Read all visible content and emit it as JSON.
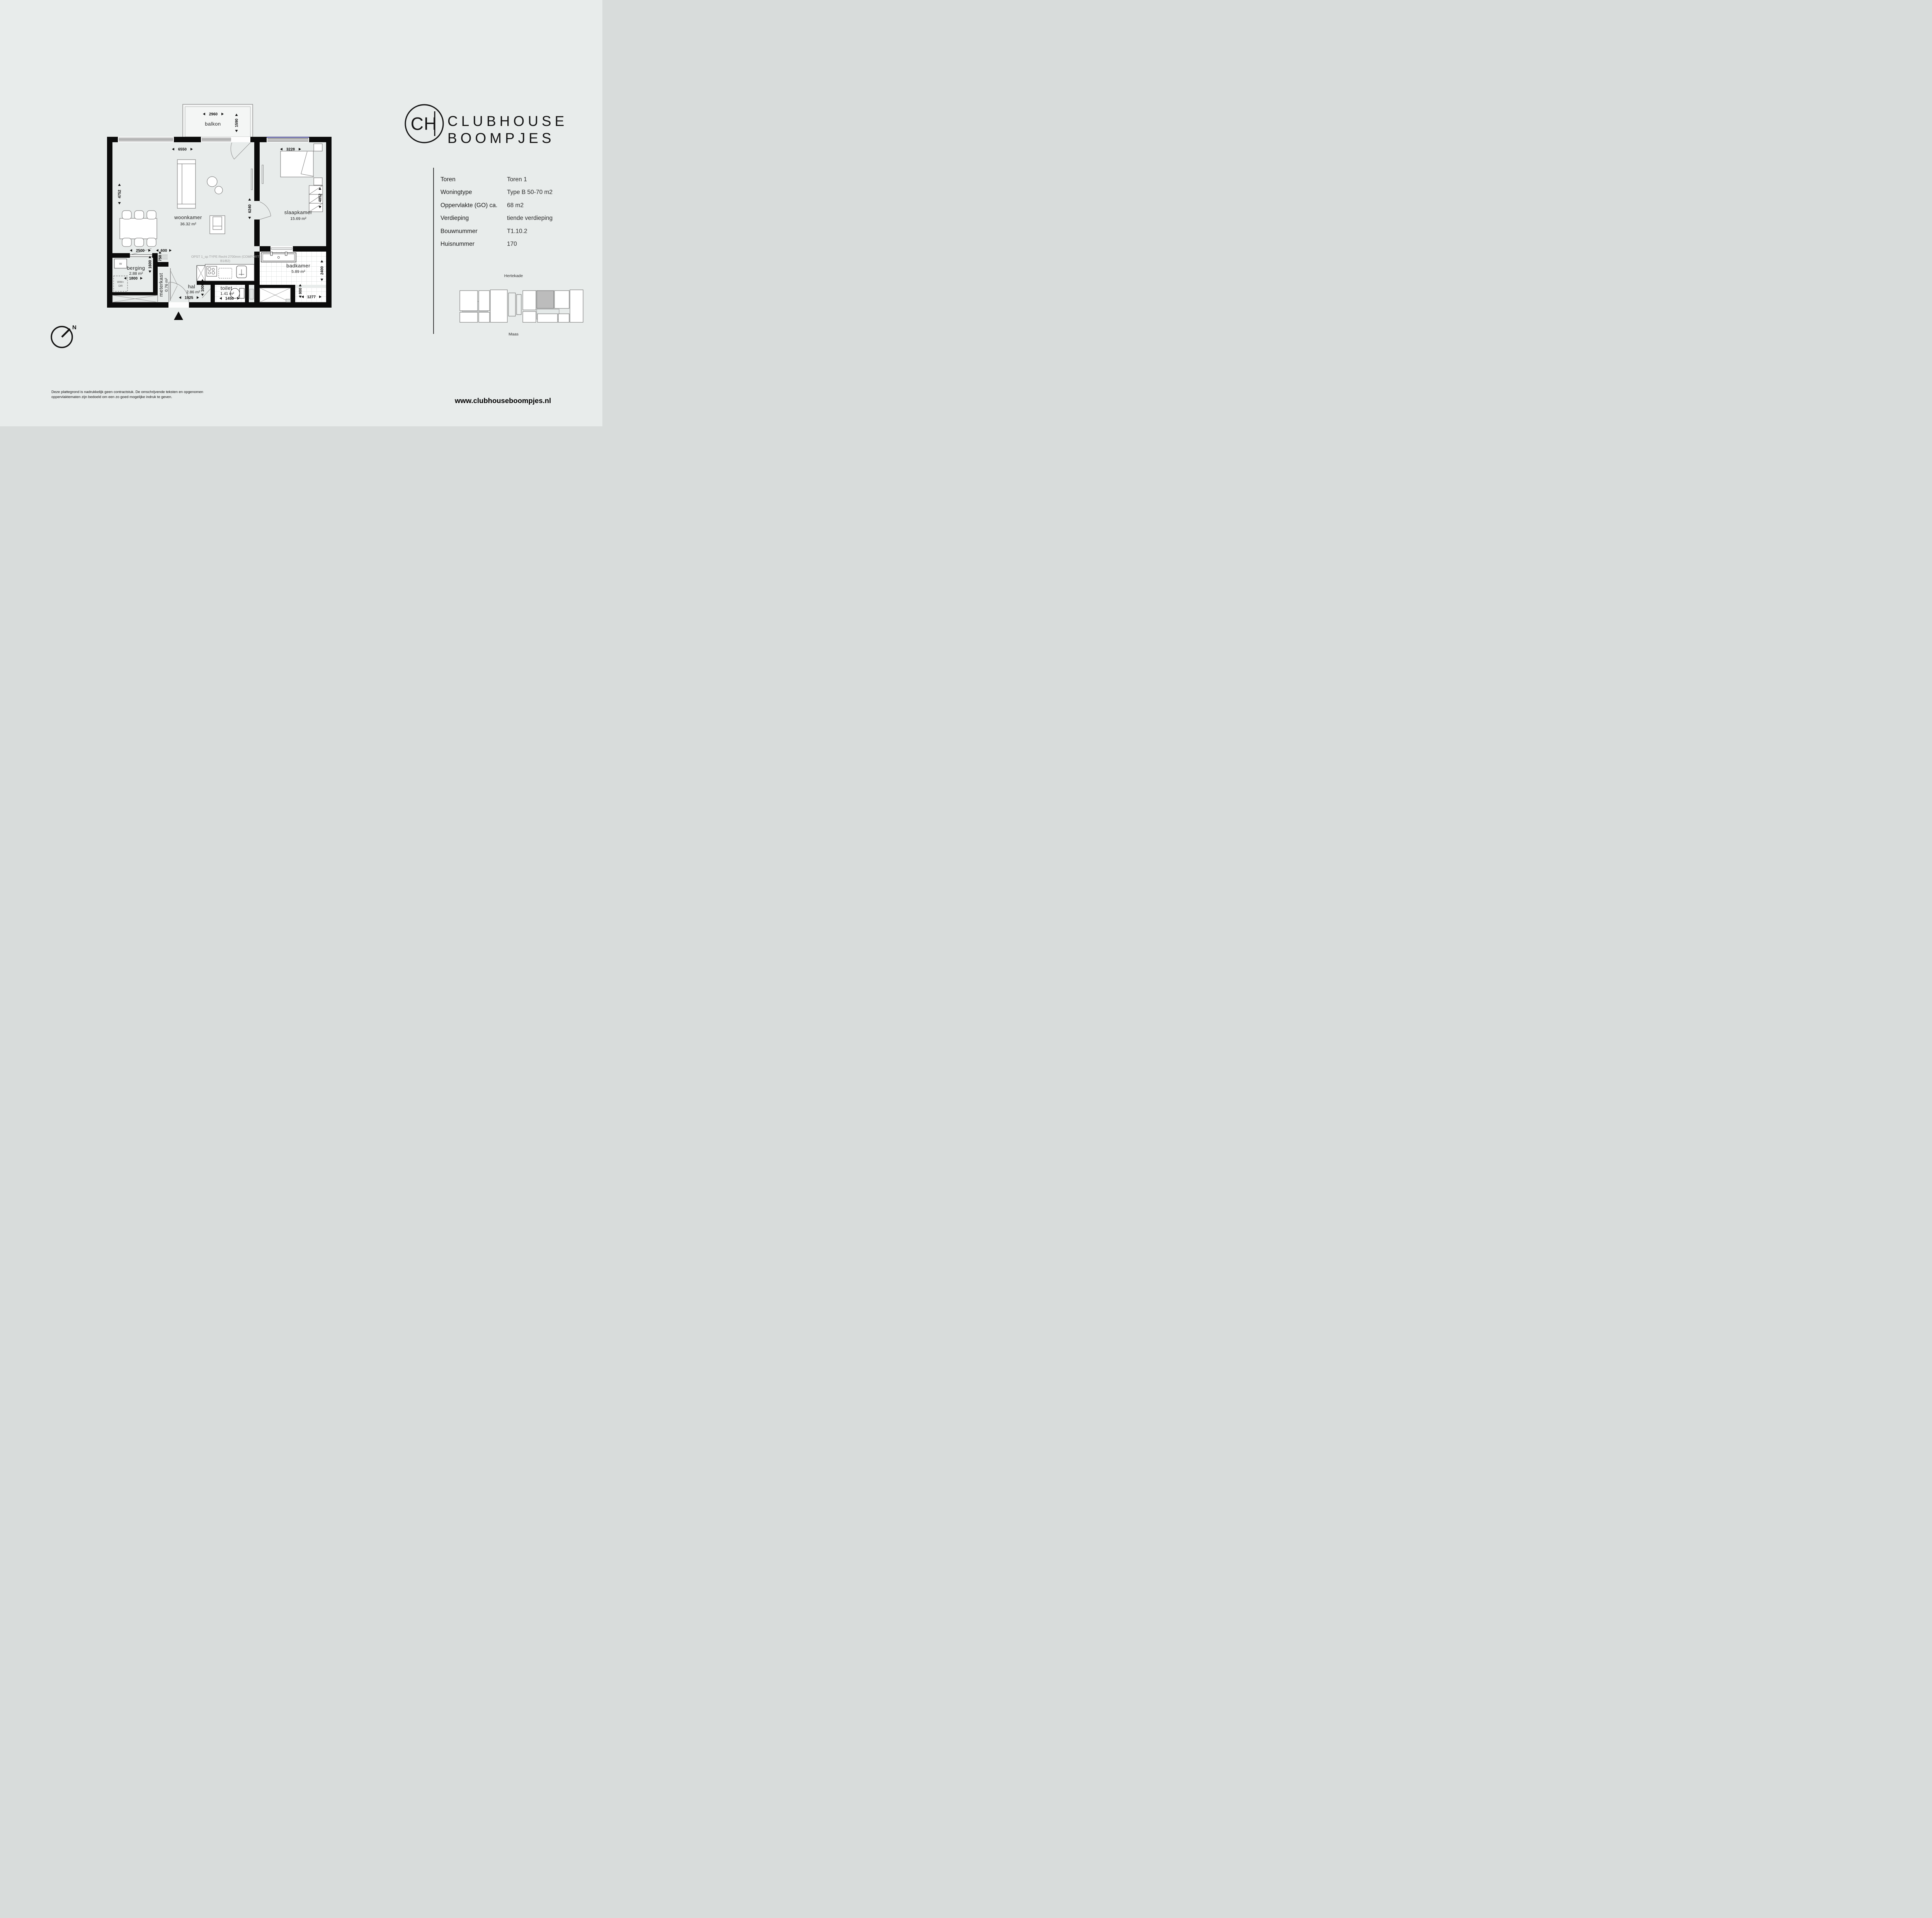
{
  "branding": {
    "monogram": "CH",
    "name_line1": "CLUBHOUSE",
    "name_line2": "BOOMPJES",
    "website": "www.clubhouseboompjes.nl"
  },
  "info_panel": {
    "rows": [
      {
        "label": "Toren",
        "value": "Toren 1"
      },
      {
        "label": "Woningtype",
        "value": "Type B 50-70 m2"
      },
      {
        "label": "Oppervlakte (GO) ca.",
        "value": "68 m2"
      },
      {
        "label": "Verdieping",
        "value": "tiende verdieping"
      },
      {
        "label": "Bouwnummer",
        "value": "T1.10.2"
      },
      {
        "label": "Huisnummer",
        "value": "170"
      }
    ]
  },
  "floor_plan": {
    "balcony": {
      "label": "balkon",
      "width": "2960",
      "depth": "1590"
    },
    "rooms": {
      "woonkamer": {
        "label": "woonkamer",
        "area": "36.32 m²"
      },
      "slaapkamer": {
        "label": "slaapkamer",
        "area": "15.69 m²"
      },
      "badkamer": {
        "label": "badkamer",
        "area": "5.89 m²"
      },
      "berging": {
        "label": "berging",
        "area": "2.88 m²"
      },
      "meterkast": {
        "label": "meterkast",
        "area": "0.76 m²"
      },
      "hal": {
        "label": "hal",
        "area": "2.86 m²"
      },
      "toilet": {
        "label": "toilet",
        "area": "1.41 m²"
      }
    },
    "dims": {
      "woonkamer_width": "6550",
      "woonkamer_depth": "4752",
      "living_right_depth": "6240",
      "slaapkamer_width": "3228",
      "slaapkamer_depth": "4852",
      "berging_door_width": "2500",
      "berging_width": "1800",
      "berging_depth": "1600",
      "kast_width": "600",
      "kast_depth": "750",
      "hal_width": "1925",
      "hal_depth": "1000",
      "toilet_width": "1450",
      "badkamer_depth": "2400",
      "badkamer_niche_depth": "900",
      "badkamer_niche_width": "1277"
    },
    "kitchen_note_line1": "OPST 1_sp TYPE Recht 2700mm (COMFORT",
    "kitchen_note_line2": "B1/B2)",
    "appliances": {
      "washer": "W",
      "wm_line1": "WM+",
      "wm_line2": "DR"
    },
    "compass_label": "N"
  },
  "site_map": {
    "street_top": "Hertekade",
    "street_bottom": "Maas"
  },
  "footer": {
    "disclaimer_line1": "Deze plattegrond is nadrukkelijk geen contractstuk. De omschrijvende teksten en opgenomen",
    "disclaimer_line2": "oppervlaktematen zijn bedoeld om een zo goed mogelijke indruk te geven."
  }
}
